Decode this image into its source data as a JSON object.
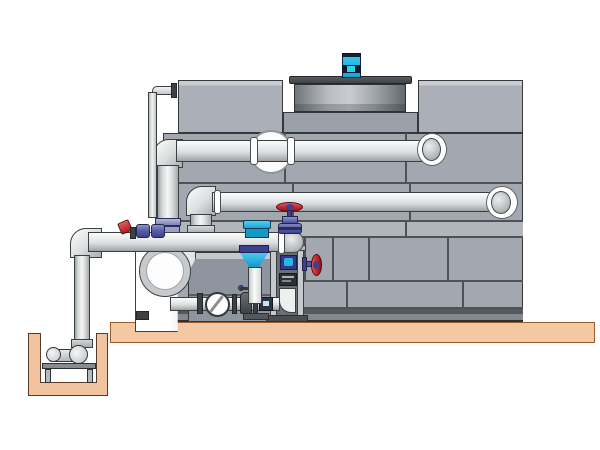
{
  "scene": {
    "description": "Side-view technical diagram of a closed-circuit cooling tower with external pump skid, separator, valve train and in-ground sump pit",
    "background_color": "#ffffff"
  },
  "colors": {
    "tower_panel": "#a2a7b0",
    "tower_panel_band": "#b1b5bc",
    "panel_seam": "#4e5257",
    "dark_outline": "#34383b",
    "pipe_highlight": "#f5f6f6",
    "pipe_shadow": "#9da1a3",
    "slab_tan": "#f4c8a2",
    "slab_outline": "#9c5b2b",
    "pit_outline": "#5a3a22",
    "accent_cyan": "#25b2e2",
    "accent_red": "#c8252b",
    "valve_navy": "#5157a5",
    "frame_gray": "#c6cace",
    "base_dark": "#54585c"
  },
  "components": {
    "tower": {
      "label": "Cooling tower casing"
    },
    "box_left": {
      "label": "Upper casing section left"
    },
    "box_right": {
      "label": "Upper casing section right"
    },
    "fan_cowl": {
      "label": "Fan discharge cowl"
    },
    "fan_motor": {
      "label": "Fan drive motor"
    },
    "upper_pipe": {
      "label": "Upper return pipe"
    },
    "lower_pipe": {
      "label": "Lower return pipe"
    },
    "riser": {
      "label": "Riser pipe"
    },
    "makeup_line": {
      "label": "Make-up water line"
    },
    "header": {
      "label": "Pump suction header"
    },
    "suction_drop": {
      "label": "Sump suction drop pipe"
    },
    "slab": {
      "label": "Concrete equipment slab"
    },
    "pit": {
      "label": "Concrete sump pit"
    },
    "sump_pump": {
      "label": "Sump pump"
    },
    "pump_stand": {
      "label": "Sump pump stand"
    },
    "separator": {
      "label": "Centrifugal separator"
    },
    "skid": {
      "label": "Pump and filtration skid"
    },
    "strainer": {
      "label": "Inline strainer with cone"
    },
    "globe_valve": {
      "label": "Globe valve with red handwheel"
    },
    "side_valve": {
      "label": "Side butterfly valve"
    },
    "ball_valves": {
      "label": "Isolation ball valves"
    },
    "sight_glass": {
      "label": "Sight glass"
    },
    "sample_valve": {
      "label": "Sampling valve"
    },
    "rack": {
      "label": "Instrument rack"
    },
    "inlet_flange": {
      "label": "Tower inlet flange"
    }
  }
}
